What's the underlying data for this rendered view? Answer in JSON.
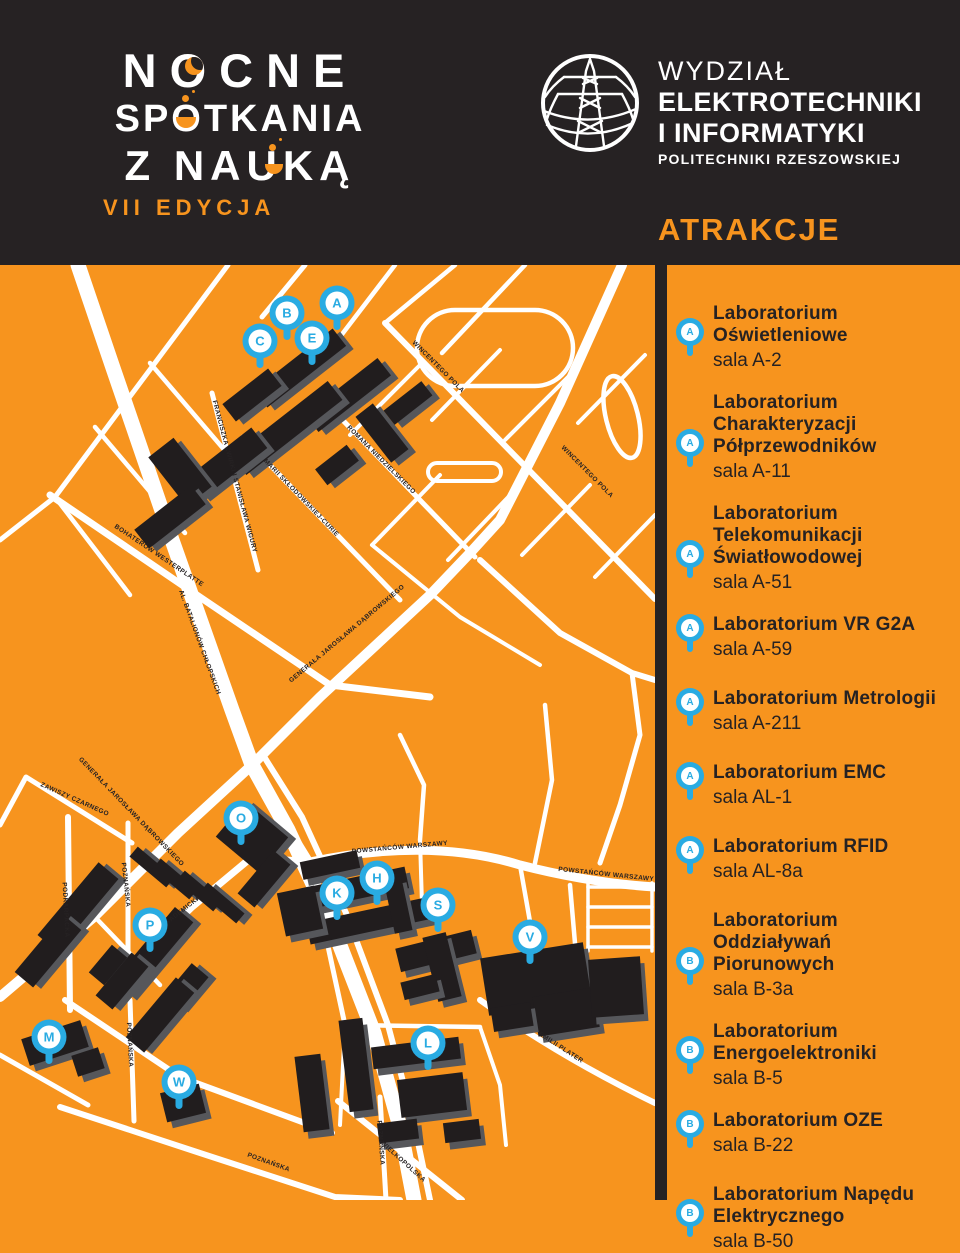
{
  "colors": {
    "orange": "#F7941E",
    "dark": "#262223",
    "blue": "#29ABE2",
    "white": "#FFFFFF",
    "building_top": "#211D1E",
    "building_side": "#56575B"
  },
  "header": {
    "logo": {
      "line1": "NOCNE",
      "line2": "SPOTKANIA",
      "line3": "Z NAUKĄ",
      "edition": "VII EDYCJA"
    },
    "faculty": {
      "line1": "WYDZIAŁ",
      "line2": "ELEKTROTECHNIKI",
      "line3": "I INFORMATYKI",
      "line4": "POLITECHNIKI RZESZOWSKIEJ"
    },
    "section_title": "ATRAKCJE"
  },
  "map": {
    "street_labels": [
      {
        "text": "WINCENTEGO POLA",
        "x": 437,
        "y": 103,
        "rot": 45
      },
      {
        "text": "WINCENTEGO POLA",
        "x": 586,
        "y": 208,
        "rot": 45
      },
      {
        "text": "ROMANA NIEDZIELSKIEGO",
        "x": 380,
        "y": 196,
        "rot": 45
      },
      {
        "text": "MARII SKŁODOWSKIEJ-CURIE",
        "x": 300,
        "y": 234,
        "rot": 46
      },
      {
        "text": "FRANCISZKA ŻWIRKI I STANISŁAWA WIGURY",
        "x": 233,
        "y": 212,
        "rot": 75
      },
      {
        "text": "BOHATERÓW WESTERPLATTE",
        "x": 158,
        "y": 292,
        "rot": 34
      },
      {
        "text": "AL. BATALIONÓW CHŁOPSKICH",
        "x": 198,
        "y": 378,
        "rot": 70
      },
      {
        "text": "GENERAŁA JAROSŁAWA DĄBROWSKIEGO",
        "x": 348,
        "y": 370,
        "rot": -40
      },
      {
        "text": "GENERAŁA JAROSŁAWA DĄBROWSKIEGO",
        "x": 130,
        "y": 548,
        "rot": 46
      },
      {
        "text": "ZAWISZY CZARNEGO",
        "x": 74,
        "y": 536,
        "rot": 24
      },
      {
        "text": "PODKARPACKA",
        "x": 64,
        "y": 645,
        "rot": 87
      },
      {
        "text": "POZNAŃSKA",
        "x": 124,
        "y": 620,
        "rot": 84
      },
      {
        "text": "AKADEMICKA",
        "x": 182,
        "y": 648,
        "rot": -38
      },
      {
        "text": "POWSTAŃCÓW WARSZAWY",
        "x": 400,
        "y": 584,
        "rot": -5
      },
      {
        "text": "POWSTAŃCÓW WARSZAWY",
        "x": 606,
        "y": 611,
        "rot": 6
      },
      {
        "text": "EMILII PLATER",
        "x": 560,
        "y": 784,
        "rot": 33
      },
      {
        "text": "POZNAŃSKA",
        "x": 128,
        "y": 780,
        "rot": 87
      },
      {
        "text": "POZNAŃSKA",
        "x": 268,
        "y": 899,
        "rot": 20
      },
      {
        "text": "POZNAŃSKA",
        "x": 379,
        "y": 878,
        "rot": 86
      },
      {
        "text": "WIELKOPOLSKA",
        "x": 402,
        "y": 898,
        "rot": 42
      }
    ],
    "pins": [
      {
        "letter": "A",
        "x": 337,
        "y": 38
      },
      {
        "letter": "B",
        "x": 287,
        "y": 48
      },
      {
        "letter": "C",
        "x": 260,
        "y": 76
      },
      {
        "letter": "E",
        "x": 312,
        "y": 73
      },
      {
        "letter": "O",
        "x": 241,
        "y": 553
      },
      {
        "letter": "P",
        "x": 150,
        "y": 660
      },
      {
        "letter": "K",
        "x": 337,
        "y": 628
      },
      {
        "letter": "H",
        "x": 377,
        "y": 613
      },
      {
        "letter": "S",
        "x": 438,
        "y": 640
      },
      {
        "letter": "V",
        "x": 530,
        "y": 672
      },
      {
        "letter": "L",
        "x": 428,
        "y": 778
      },
      {
        "letter": "M",
        "x": 49,
        "y": 772
      },
      {
        "letter": "W",
        "x": 179,
        "y": 817
      }
    ]
  },
  "attractions": [
    {
      "pin": "A",
      "title": "Laboratorium Oświetleniowe",
      "room": "sala A-2"
    },
    {
      "pin": "A",
      "title": "Laboratorium Charakteryzacji Półprzewodników",
      "room": "sala A-11"
    },
    {
      "pin": "A",
      "title": "Laboratorium Telekomunikacji Światłowodowej",
      "room": "sala A-51"
    },
    {
      "pin": "A",
      "title": "Laboratorium VR G2A",
      "room": "sala A-59"
    },
    {
      "pin": "A",
      "title": "Laboratorium Metrologii",
      "room": "sala A-211"
    },
    {
      "pin": "A",
      "title": "Laboratorium EMC",
      "room": "sala AL-1"
    },
    {
      "pin": "A",
      "title": "Laboratorium RFID",
      "room": "sala AL-8a"
    },
    {
      "pin": "B",
      "title": "Laboratorium Oddziaływań Piorunowych",
      "room": "sala B-3a"
    },
    {
      "pin": "B",
      "title": "Laboratorium Energoelektroniki",
      "room": "sala B-5"
    },
    {
      "pin": "B",
      "title": "Laboratorium OZE",
      "room": "sala B-22"
    },
    {
      "pin": "B",
      "title": "Laboratorium Napędu Elektrycznego",
      "room": "sala B-50"
    }
  ]
}
